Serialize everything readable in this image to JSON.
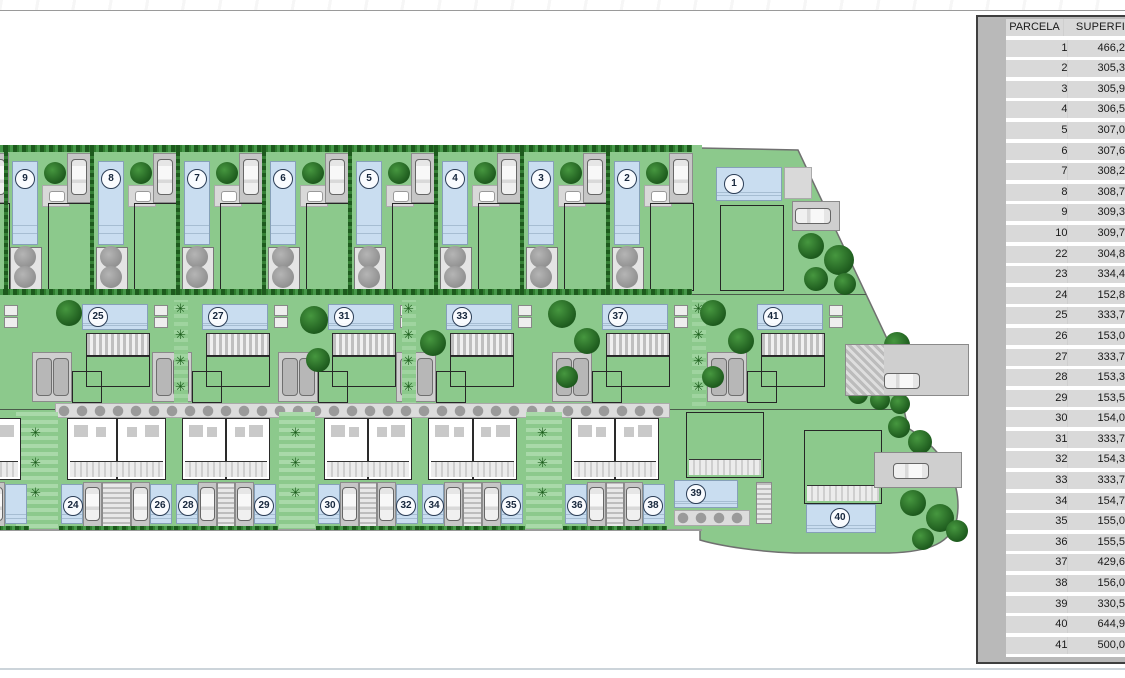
{
  "plan": {
    "top_row_labels": [
      "9",
      "8",
      "7",
      "6",
      "5",
      "4",
      "3",
      "2"
    ],
    "unit_1": "1",
    "middle_row_labels": [
      "25",
      "27",
      "31",
      "33",
      "37",
      "41"
    ],
    "townhouse_pairs": [
      [
        "24",
        "26"
      ],
      [
        "28",
        "29"
      ],
      [
        "30",
        "32"
      ],
      [
        "34",
        "35"
      ],
      [
        "36",
        "38"
      ]
    ],
    "unit_39": "39",
    "unit_40": "40"
  },
  "table": {
    "headers": [
      "PARCELA",
      "SUPERFI"
    ],
    "rows": [
      [
        "1",
        "466,2"
      ],
      [
        "2",
        "305,3"
      ],
      [
        "3",
        "305,9"
      ],
      [
        "4",
        "306,5"
      ],
      [
        "5",
        "307,0"
      ],
      [
        "6",
        "307,6"
      ],
      [
        "7",
        "308,2"
      ],
      [
        "8",
        "308,7"
      ],
      [
        "9",
        "309,3"
      ],
      [
        "10",
        "309,7"
      ],
      [
        "22",
        "304,8"
      ],
      [
        "23",
        "334,4"
      ],
      [
        "24",
        "152,8"
      ],
      [
        "25",
        "333,7"
      ],
      [
        "26",
        "153,0"
      ],
      [
        "27",
        "333,7"
      ],
      [
        "28",
        "153,3"
      ],
      [
        "29",
        "153,5"
      ],
      [
        "30",
        "154,0"
      ],
      [
        "31",
        "333,7"
      ],
      [
        "32",
        "154,3"
      ],
      [
        "33",
        "333,7"
      ],
      [
        "34",
        "154,7"
      ],
      [
        "35",
        "155,0"
      ],
      [
        "36",
        "155,5"
      ],
      [
        "37",
        "429,6"
      ],
      [
        "38",
        "156,0"
      ],
      [
        "39",
        "330,5"
      ],
      [
        "40",
        "644,9"
      ],
      [
        "41",
        "500,0"
      ]
    ]
  },
  "icons": {
    "palm": "✳"
  },
  "colors": {
    "lawn": "#8cc98c",
    "pool": "#c9ddf0",
    "tree_dark": "#1d5a1d",
    "panel_bg": "#b9b9b9",
    "cell_bg": "#d9d9d9",
    "boundary": "#707070"
  }
}
